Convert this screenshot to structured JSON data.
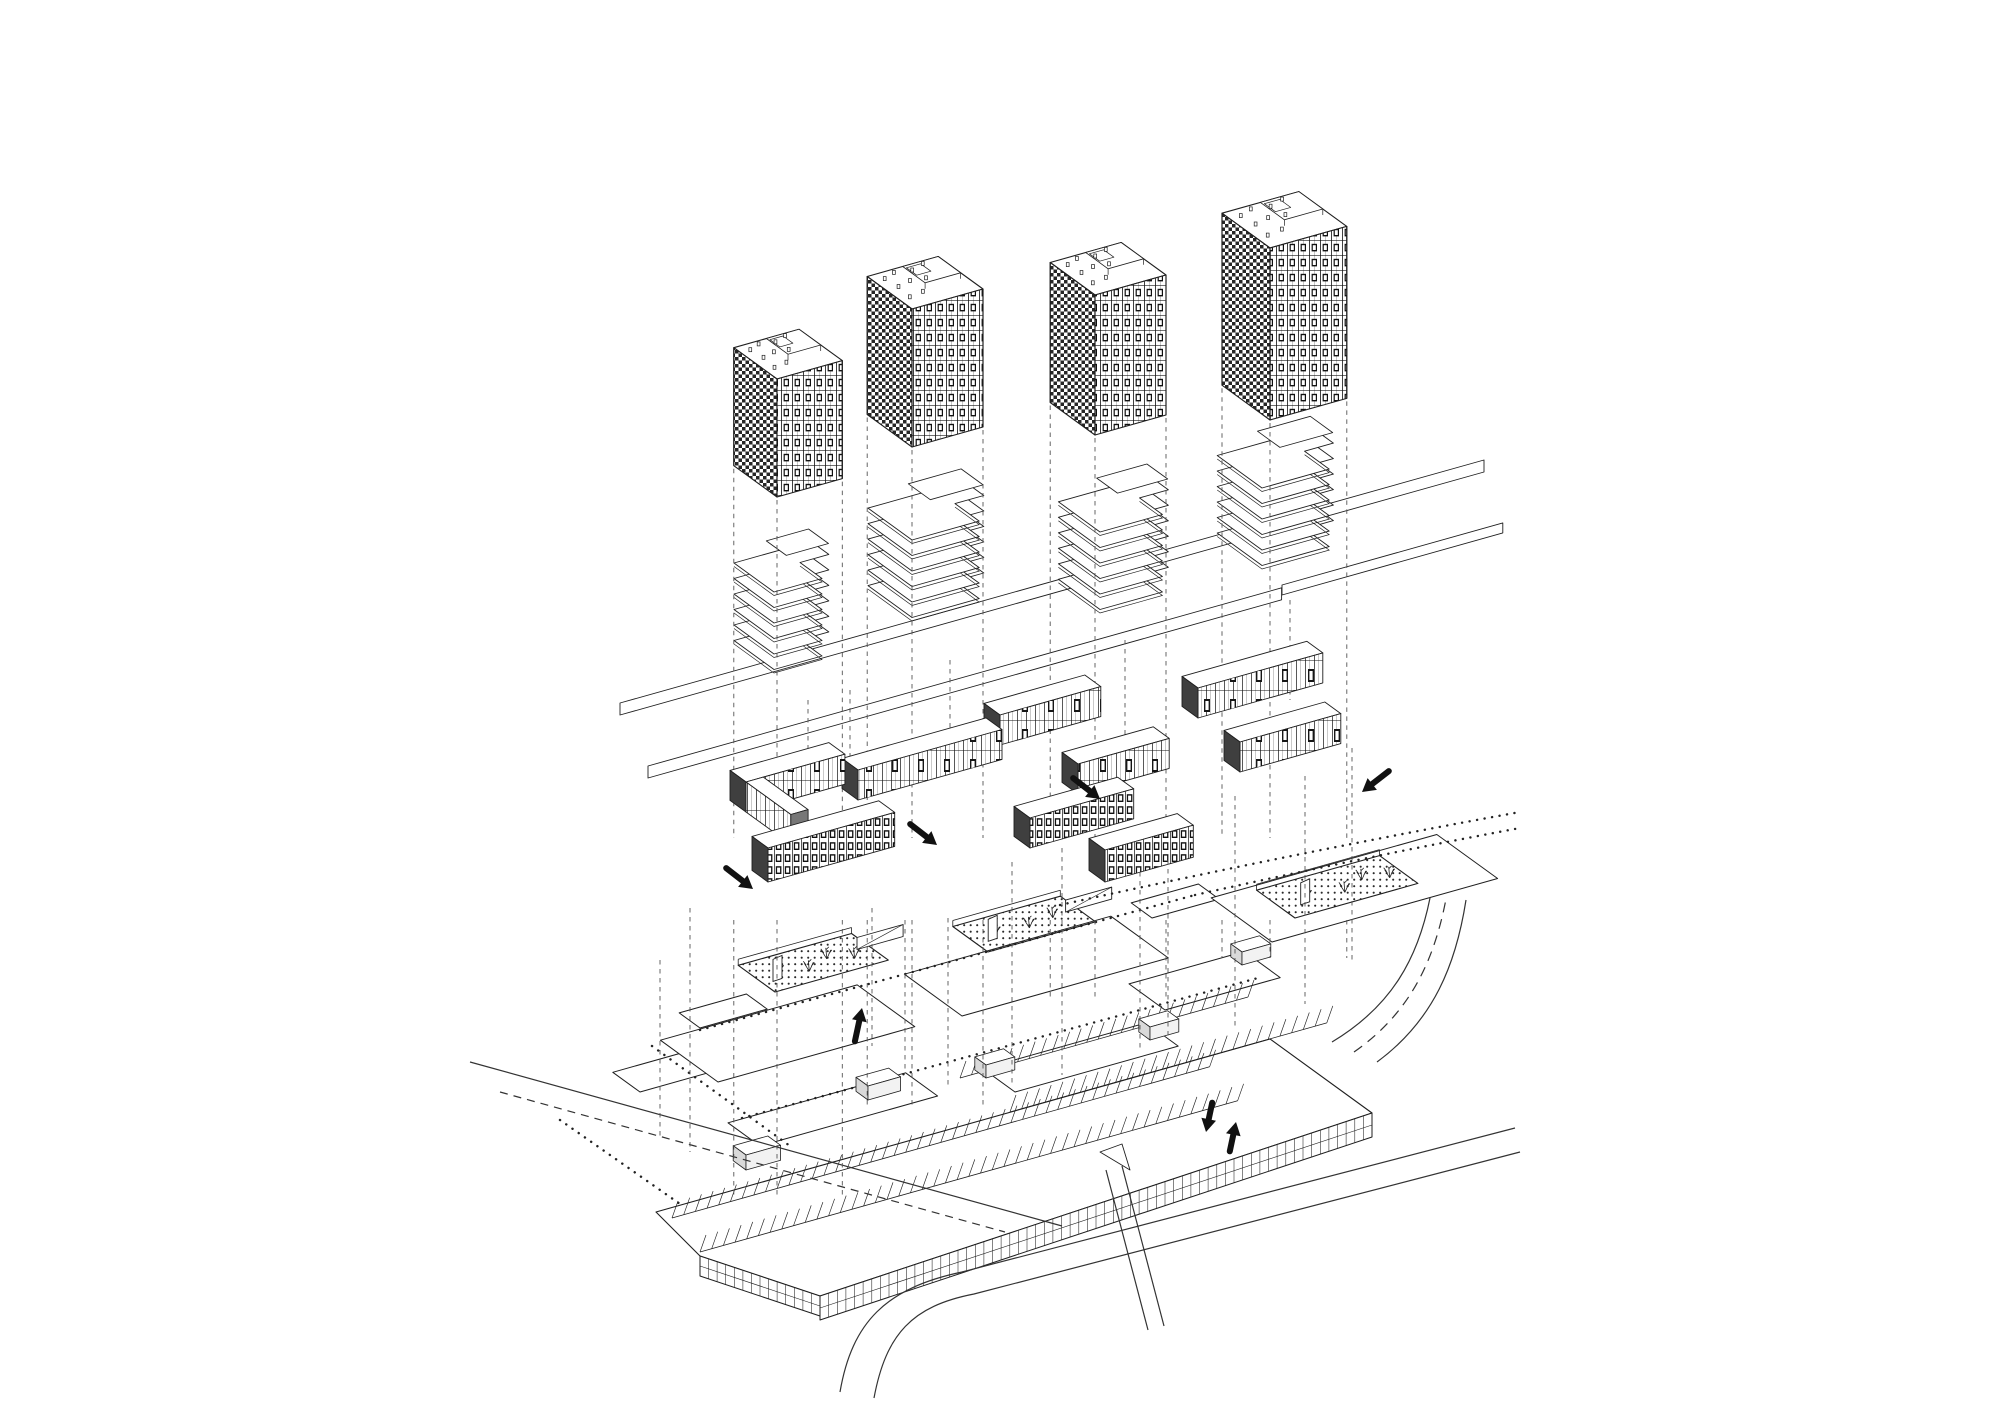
{
  "meta": {
    "width": 2000,
    "height": 1414,
    "paper": "#ffffff",
    "ink": "#1f1f1f",
    "dark_fill": "#3f3f3f",
    "dash_color": "#555555",
    "diagram_kind": "exploded-axonometric-site-diagram"
  },
  "axes": {
    "u": [
      0.96,
      -0.27
    ],
    "v": [
      0.8,
      0.58
    ]
  },
  "layers": {
    "towers": {
      "name": "residential-towers",
      "items": [
        {
          "A": [
            777,
            497
          ],
          "L": 68,
          "D": 54,
          "H": 118,
          "drop": 1195
        },
        {
          "A": [
            912,
            447
          ],
          "L": 74,
          "D": 56,
          "H": 138,
          "drop": 1108
        },
        {
          "A": [
            1095,
            435
          ],
          "L": 74,
          "D": 56,
          "H": 140,
          "drop": 997
        },
        {
          "A": [
            1270,
            420
          ],
          "L": 80,
          "D": 60,
          "H": 172,
          "drop": 958
        }
      ],
      "roof_objects": [
        [
          0.12,
          0.2
        ],
        [
          0.3,
          0.12
        ],
        [
          0.52,
          0.18
        ],
        [
          0.72,
          0.1
        ],
        [
          0.15,
          0.46
        ],
        [
          0.35,
          0.4
        ],
        [
          0.55,
          0.44
        ],
        [
          0.12,
          0.76
        ],
        [
          0.33,
          0.72
        ],
        [
          0.55,
          0.78
        ],
        [
          0.75,
          0.72
        ]
      ]
    },
    "terraces": {
      "name": "terraced-slab-stacks",
      "items": [
        {
          "A": [
            774,
            592
          ],
          "L": 80,
          "D": 50,
          "plates": 6,
          "step": 15.5
        },
        {
          "A": [
            912,
            540
          ],
          "L": 100,
          "D": 55,
          "plates": 6,
          "step": 15.5
        },
        {
          "A": [
            1100,
            532
          ],
          "L": 95,
          "D": 52,
          "plates": 6,
          "step": 15.5
        },
        {
          "A": [
            1262,
            488
          ],
          "L": 100,
          "D": 56,
          "plates": 6,
          "step": 15.5
        }
      ],
      "bands": [
        {
          "A": [
            620,
            703
          ],
          "L": 900,
          "T": 12
        },
        {
          "A": [
            648,
            766
          ],
          "L": 660,
          "T": 12
        },
        {
          "A": [
            1282,
            585
          ],
          "L": 230,
          "T": 10
        }
      ]
    },
    "bars": {
      "name": "courtyard-blocks",
      "items": [
        {
          "A": [
            1198,
            718
          ],
          "L": 130,
          "kind": "u",
          "pat": "light",
          "H": 30
        },
        {
          "A": [
            1000,
            745
          ],
          "L": 105,
          "kind": "u",
          "pat": "light",
          "H": 30
        },
        {
          "A": [
            1240,
            772
          ],
          "L": 105,
          "kind": "u",
          "pat": "light",
          "H": 30
        },
        {
          "A": [
            1078,
            794
          ],
          "L": 95,
          "kind": "u",
          "pat": "light",
          "H": 30
        },
        {
          "A": [
            858,
            800
          ],
          "L": 150,
          "kind": "u",
          "pat": "light",
          "H": 30
        },
        {
          "A": [
            746,
            812
          ],
          "L": 103,
          "kind": "u",
          "pat": "light",
          "H": 30
        },
        {
          "A": [
            746,
            812
          ],
          "Lv": 56,
          "kind": "v",
          "pat": "light",
          "H": 30
        },
        {
          "A": [
            1105,
            882
          ],
          "L": 92,
          "kind": "u",
          "pat": "dense",
          "H": 32
        },
        {
          "A": [
            1030,
            848
          ],
          "L": 108,
          "kind": "u",
          "pat": "dense",
          "H": 30
        },
        {
          "A": [
            768,
            882
          ],
          "L": 132,
          "kind": "u",
          "pat": "dense",
          "H": 34
        }
      ]
    },
    "plaza": {
      "name": "podium-deck",
      "decks": [
        {
          "A": [
            640,
            1092
          ],
          "L": 95,
          "D": 34
        },
        {
          "A": [
            700,
            1028
          ],
          "L": 70,
          "D": 26
        },
        {
          "A": [
            718,
            1082
          ],
          "L": 205,
          "D": 72
        },
        {
          "A": [
            962,
            1016
          ],
          "L": 215,
          "D": 72
        },
        {
          "A": [
            1152,
            918
          ],
          "L": 70,
          "D": 26
        },
        {
          "A": [
            1165,
            1010
          ],
          "L": 120,
          "D": 45
        },
        {
          "A": [
            1272,
            942
          ],
          "L": 235,
          "D": 76
        },
        {
          "A": [
            760,
            1146
          ],
          "L": 185,
          "D": 40
        },
        {
          "A": [
            1015,
            1092
          ],
          "L": 170,
          "D": 40
        }
      ],
      "islands": [
        {
          "A": [
            775,
            992
          ],
          "L": 118,
          "D": 46,
          "trees": [
            [
              0.18,
              0.45
            ],
            [
              0.4,
              0.3
            ],
            [
              0.62,
              0.5
            ],
            [
              0.8,
              0.3
            ]
          ],
          "panel": [
            0.08,
            0.3
          ],
          "ramp": true
        },
        {
          "A": [
            988,
            952
          ],
          "L": 112,
          "D": 44,
          "trees": [
            [
              0.2,
              0.4
            ],
            [
              0.5,
              0.35
            ],
            [
              0.75,
              0.45
            ]
          ],
          "panel": [
            0.1,
            0.3
          ],
          "ramp": true
        },
        {
          "A": [
            1295,
            918
          ],
          "L": 128,
          "D": 48,
          "trees": [
            [
              0.22,
              0.4
            ],
            [
              0.5,
              0.3
            ],
            [
              0.7,
              0.5
            ],
            [
              0.88,
              0.35
            ]
          ],
          "panel": [
            0.14,
            0.3
          ],
          "ramp": false
        }
      ],
      "dotted_paths": [
        {
          "d": "M 700 1030 L 1195 895"
        },
        {
          "d": "M 1195 895 Q 1360 858 1520 828"
        },
        {
          "d": "M 742 1118 L 1258 978"
        },
        {
          "d": "M 652 1046 L 790 1146"
        },
        {
          "d": "M 1060 905 Q 1300 852 1520 812"
        },
        {
          "d": "M 560 1120 L 700 1218"
        }
      ]
    },
    "parking": {
      "name": "parking-deck",
      "slab": [
        [
          656,
          1212
        ],
        [
          1270,
          1039
        ],
        [
          1372,
          1113
        ],
        [
          820,
          1296
        ],
        [
          700,
          1256
        ]
      ],
      "stall_rows": [
        {
          "A": [
            672,
            1218
          ],
          "L": 560,
          "n": 46
        },
        {
          "A": [
            700,
            1252
          ],
          "L": 560,
          "n": 46
        },
        {
          "A": [
            1010,
            1112
          ],
          "L": 330,
          "n": 27
        },
        {
          "A": [
            960,
            1078
          ],
          "L": 300,
          "n": 25
        }
      ],
      "facade_edge": {
        "from": [
          820,
          1296
        ],
        "to": [
          1372,
          1113
        ],
        "depth": 24,
        "tick": 9
      },
      "bevel_edge": {
        "from": [
          700,
          1256
        ],
        "to": [
          820,
          1296
        ],
        "depth": 20,
        "tick": 9
      },
      "cores": [
        {
          "A": [
            746,
            1170
          ],
          "L": 36,
          "D": 16,
          "H": 15
        },
        {
          "A": [
            868,
            1100
          ],
          "L": 34,
          "D": 15,
          "H": 14
        },
        {
          "A": [
            986,
            1078
          ],
          "L": 30,
          "D": 14,
          "H": 13
        },
        {
          "A": [
            1150,
            1040
          ],
          "L": 30,
          "D": 14,
          "H": 13
        },
        {
          "A": [
            1242,
            965
          ],
          "L": 30,
          "D": 14,
          "H": 13
        }
      ]
    },
    "roads": {
      "name": "roads",
      "paths": [
        {
          "d": "M 840 1392 C 852 1322 886 1288 962 1272 L 1515 1128",
          "dash": ""
        },
        {
          "d": "M 874 1398 C 886 1334 912 1306 974 1294 L 1520 1152",
          "dash": ""
        },
        {
          "d": "M 1332 1042 C 1392 1006 1418 958 1430 898",
          "dash": ""
        },
        {
          "d": "M 1377 1062 C 1434 1020 1456 964 1466 900",
          "dash": ""
        },
        {
          "d": "M 1354 1052 C 1410 1013 1434 961 1446 899",
          "dash": "10 7"
        },
        {
          "d": "M 470 1062 L 1062 1226",
          "dash": ""
        },
        {
          "d": "M 500 1092 L 1005 1232",
          "dash": "8 6"
        },
        {
          "d": "M 1106 1170 L 1148 1330",
          "dash": ""
        },
        {
          "d": "M 1122 1166 L 1164 1326",
          "dash": ""
        }
      ],
      "wedge": [
        [
          1100,
          1152
        ],
        [
          1122,
          1144
        ],
        [
          1130,
          1170
        ]
      ]
    },
    "projections": {
      "name": "projection-lines",
      "upper_extra": [
        [
          808,
          700,
          790
        ],
        [
          850,
          690,
          782
        ],
        [
          950,
          660,
          745
        ],
        [
          1125,
          640,
          740
        ],
        [
          1290,
          600,
          700
        ]
      ],
      "lower_extra": [
        [
          872,
          908,
          1046
        ],
        [
          905,
          920,
          1072
        ],
        [
          948,
          918,
          1085
        ],
        [
          1012,
          862,
          1085
        ],
        [
          1062,
          848,
          1075
        ],
        [
          1140,
          872,
          1052
        ],
        [
          1168,
          860,
          1040
        ],
        [
          1235,
          796,
          1030
        ],
        [
          1305,
          776,
          1004
        ],
        [
          1352,
          748,
          962
        ],
        [
          690,
          908,
          1152
        ],
        [
          660,
          960,
          1140
        ]
      ]
    },
    "arrows": {
      "name": "circulation-arrows",
      "color": "#111111",
      "items": [
        {
          "tip": [
            753,
            889
          ],
          "ang": 38,
          "len": 34
        },
        {
          "tip": [
            937,
            845
          ],
          "ang": 38,
          "len": 34
        },
        {
          "tip": [
            1100,
            799
          ],
          "ang": 38,
          "len": 34
        },
        {
          "tip": [
            1362,
            792
          ],
          "ang": 142,
          "len": 34
        },
        {
          "tip": [
            862,
            1008
          ],
          "ang": -78,
          "len": 34
        },
        {
          "tip": [
            1206,
            1132
          ],
          "ang": 102,
          "len": 30
        },
        {
          "tip": [
            1236,
            1122
          ],
          "ang": -78,
          "len": 30
        }
      ]
    }
  }
}
